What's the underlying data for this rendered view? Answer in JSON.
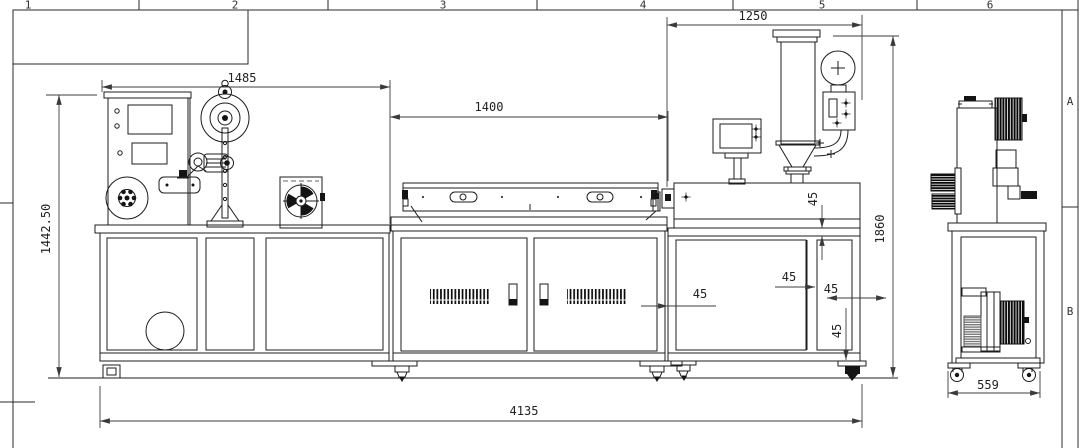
{
  "sheet": {
    "grid_columns": [
      "1",
      "2",
      "3",
      "4",
      "5",
      "6"
    ],
    "grid_rows": [
      "A",
      "B"
    ]
  },
  "dimensions": {
    "winder_section_width": "1485",
    "cooling_section_width": "1400",
    "extruder_section_width": "1250",
    "total_length": "4135",
    "left_height": "1442.50",
    "extruder_height": "1860",
    "side_depth": "559",
    "offset_barrel": "45",
    "offset_panel_left": "45",
    "offset_panel_right": "45",
    "offset_cabinet_edge": "45",
    "offset_foot": "45"
  },
  "colors": {
    "line": "#1c1c1c",
    "dimension": "#3c3c3c",
    "background": "#ffffff"
  }
}
